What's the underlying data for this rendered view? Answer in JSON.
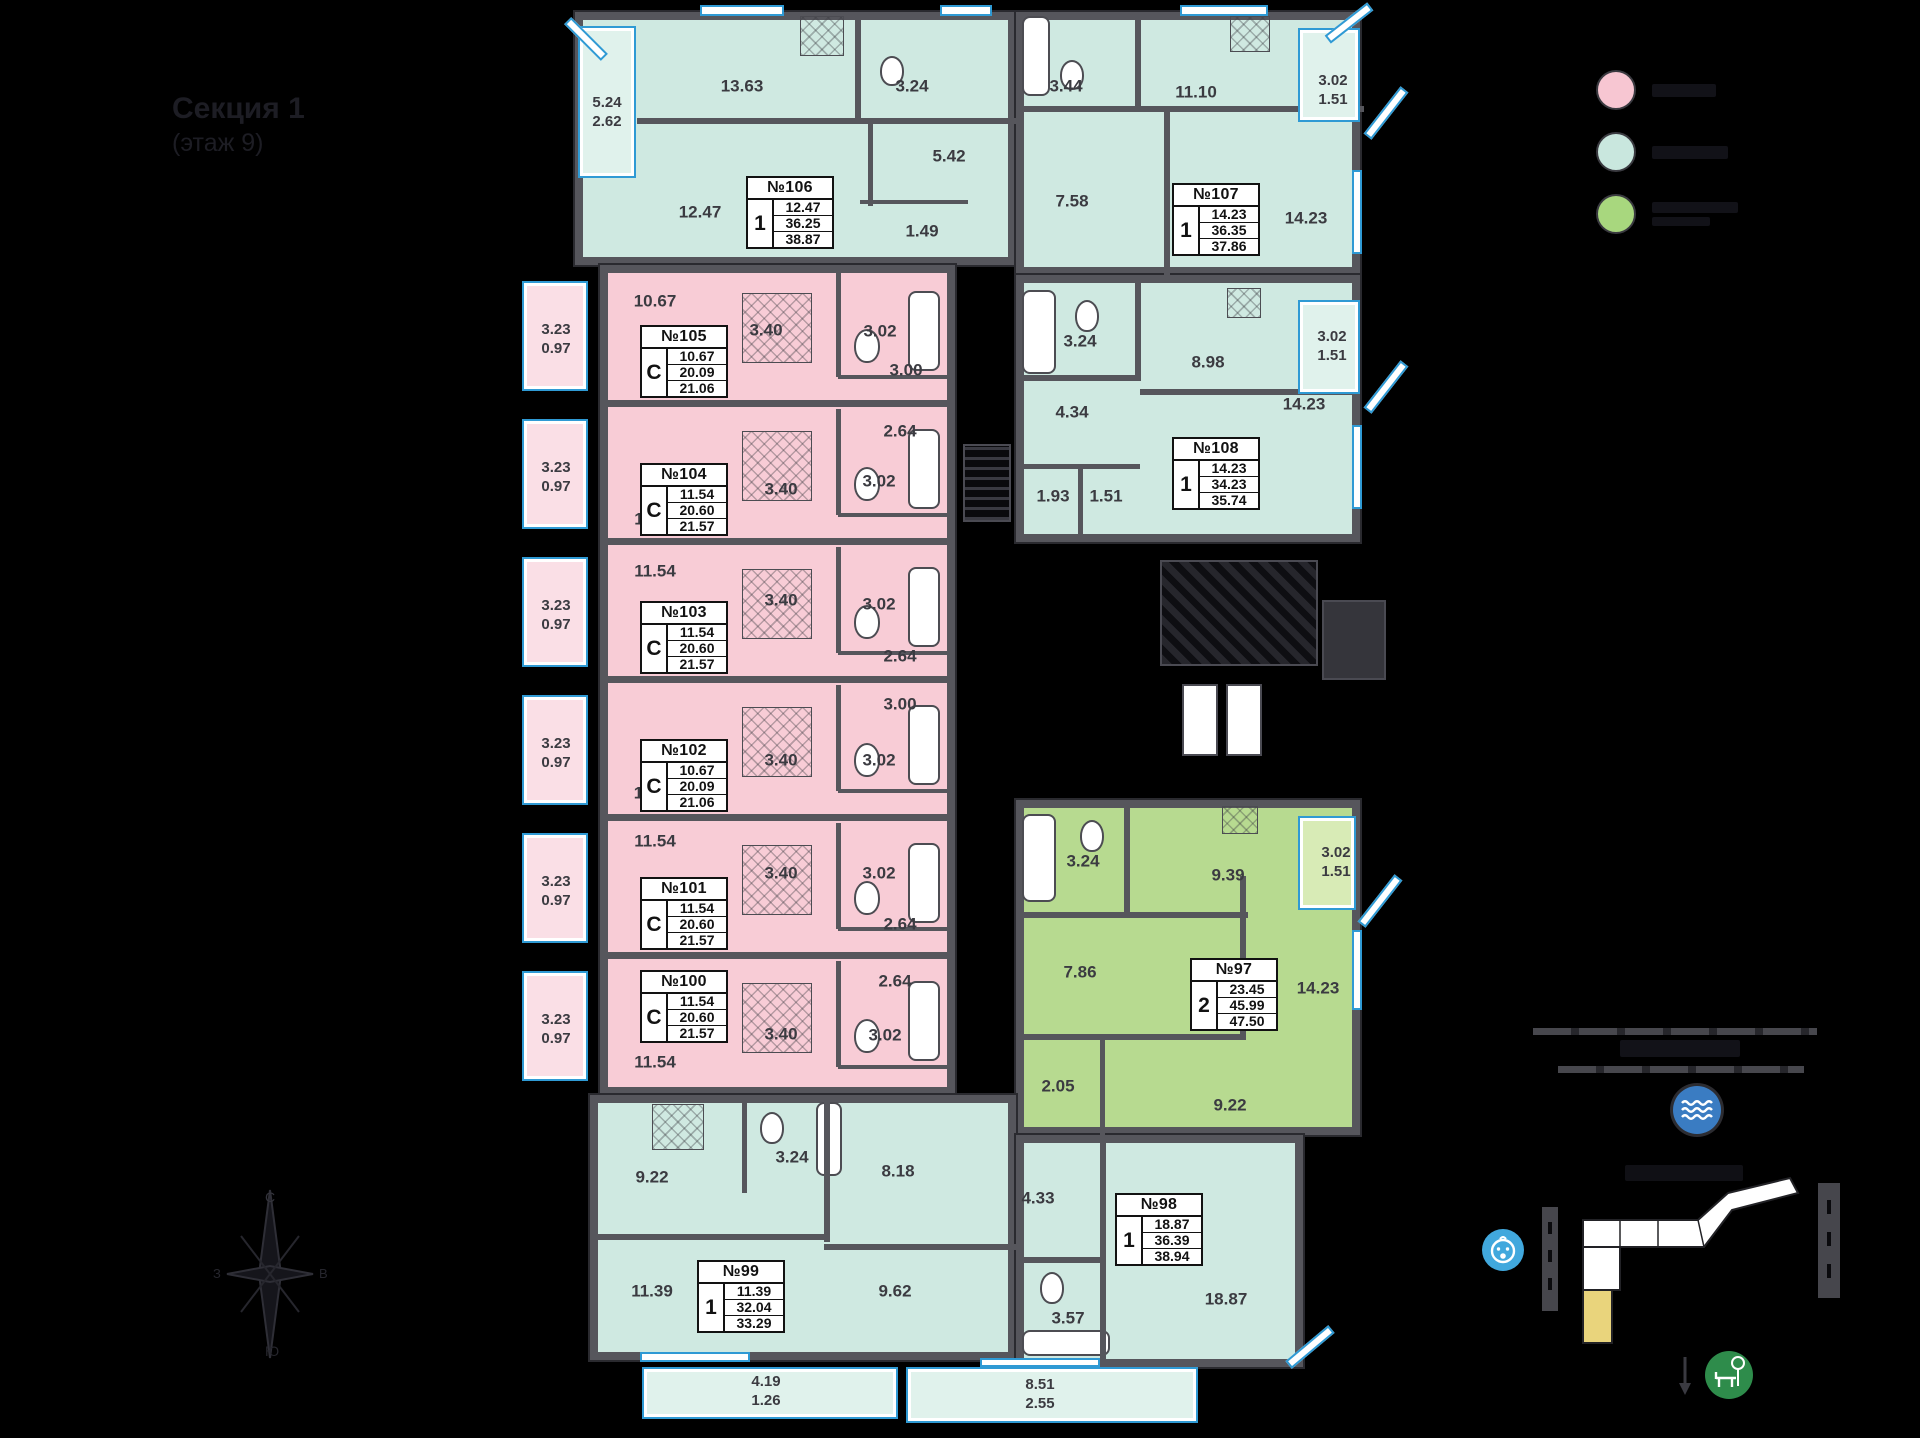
{
  "title": {
    "line1": "Секция 1",
    "line2": "(этаж 9)"
  },
  "legend": [
    {
      "name": "studio-apartments",
      "color": "#f7c6d2"
    },
    {
      "name": "one-room-apartments",
      "color": "#c9e7de"
    },
    {
      "name": "two-room-apartments",
      "color": "#a8d77e"
    }
  ],
  "colors": {
    "teal_fill": "#cfe9e1",
    "pink_fill": "#f8ccd6",
    "green_fill": "#b7da90",
    "wall": "#56565c",
    "window_blue": "#2f9ad4",
    "minimap_highlight": "#e9d47c",
    "water_icon": "#3a7cc2",
    "kindergarten_icon": "#41a8dd",
    "park_icon": "#2e8c4b"
  },
  "apartments": [
    {
      "num": "№106",
      "badge": "1",
      "living": "12.47",
      "area": "36.25",
      "total": "38.87",
      "box": {
        "x": 746,
        "y": 176
      }
    },
    {
      "num": "№107",
      "badge": "1",
      "living": "14.23",
      "area": "36.35",
      "total": "37.86",
      "box": {
        "x": 1172,
        "y": 183
      }
    },
    {
      "num": "№108",
      "badge": "1",
      "living": "14.23",
      "area": "34.23",
      "total": "35.74",
      "box": {
        "x": 1172,
        "y": 437
      }
    },
    {
      "num": "№105",
      "badge": "С",
      "living": "10.67",
      "area": "20.09",
      "total": "21.06",
      "box": {
        "x": 640,
        "y": 325
      }
    },
    {
      "num": "№104",
      "badge": "С",
      "living": "11.54",
      "area": "20.60",
      "total": "21.57",
      "box": {
        "x": 640,
        "y": 463
      }
    },
    {
      "num": "№103",
      "badge": "С",
      "living": "11.54",
      "area": "20.60",
      "total": "21.57",
      "box": {
        "x": 640,
        "y": 601
      }
    },
    {
      "num": "№102",
      "badge": "С",
      "living": "10.67",
      "area": "20.09",
      "total": "21.06",
      "box": {
        "x": 640,
        "y": 739
      }
    },
    {
      "num": "№101",
      "badge": "С",
      "living": "11.54",
      "area": "20.60",
      "total": "21.57",
      "box": {
        "x": 640,
        "y": 877
      }
    },
    {
      "num": "№100",
      "badge": "С",
      "living": "11.54",
      "area": "20.60",
      "total": "21.57",
      "box": {
        "x": 640,
        "y": 970
      }
    },
    {
      "num": "№97",
      "badge": "2",
      "living": "23.45",
      "area": "45.99",
      "total": "47.50",
      "box": {
        "x": 1190,
        "y": 958
      }
    },
    {
      "num": "№98",
      "badge": "1",
      "living": "18.87",
      "area": "36.39",
      "total": "38.94",
      "box": {
        "x": 1115,
        "y": 1193
      }
    },
    {
      "num": "№99",
      "badge": "1",
      "living": "11.39",
      "area": "32.04",
      "total": "33.29",
      "box": {
        "x": 697,
        "y": 1260
      }
    }
  ],
  "labels": [
    {
      "t": "13.63",
      "x": 742,
      "y": 86
    },
    {
      "t": "3.24",
      "x": 912,
      "y": 86
    },
    {
      "t": "5.42",
      "x": 949,
      "y": 156
    },
    {
      "t": "12.47",
      "x": 700,
      "y": 212
    },
    {
      "t": "1.49",
      "x": 922,
      "y": 231
    },
    {
      "t": "5.24",
      "t2": "2.62",
      "x": 607,
      "y": 112
    },
    {
      "t": "3.44",
      "x": 1066,
      "y": 86
    },
    {
      "t": "11.10",
      "x": 1196,
      "y": 92
    },
    {
      "t": "7.58",
      "x": 1072,
      "y": 201
    },
    {
      "t": "14.23",
      "x": 1306,
      "y": 218
    },
    {
      "t": "3.02",
      "t2": "1.51",
      "x": 1333,
      "y": 90
    },
    {
      "t": "3.24",
      "x": 1080,
      "y": 341
    },
    {
      "t": "8.98",
      "x": 1208,
      "y": 362
    },
    {
      "t": "4.34",
      "x": 1072,
      "y": 412
    },
    {
      "t": "1.93",
      "x": 1053,
      "y": 496
    },
    {
      "t": "1.51",
      "x": 1106,
      "y": 496
    },
    {
      "t": "14.23",
      "x": 1304,
      "y": 404
    },
    {
      "t": "3.02",
      "t2": "1.51",
      "x": 1332,
      "y": 346
    },
    {
      "t": "10.67",
      "x": 655,
      "y": 301
    },
    {
      "t": "3.40",
      "x": 766,
      "y": 330
    },
    {
      "t": "3.02",
      "x": 880,
      "y": 331
    },
    {
      "t": "3.00",
      "x": 906,
      "y": 370
    },
    {
      "t": "3.23",
      "t2": "0.97",
      "x": 556,
      "y": 339
    },
    {
      "t": "11.54",
      "x": 655,
      "y": 519
    },
    {
      "t": "3.40",
      "x": 781,
      "y": 489
    },
    {
      "t": "3.02",
      "x": 879,
      "y": 481
    },
    {
      "t": "2.64",
      "x": 900,
      "y": 431
    },
    {
      "t": "3.23",
      "t2": "0.97",
      "x": 556,
      "y": 477
    },
    {
      "t": "11.54",
      "x": 655,
      "y": 571
    },
    {
      "t": "3.40",
      "x": 781,
      "y": 600
    },
    {
      "t": "3.02",
      "x": 879,
      "y": 604
    },
    {
      "t": "2.64",
      "x": 900,
      "y": 656
    },
    {
      "t": "3.23",
      "t2": "0.97",
      "x": 556,
      "y": 615
    },
    {
      "t": "10.67",
      "x": 655,
      "y": 793
    },
    {
      "t": "3.40",
      "x": 781,
      "y": 760
    },
    {
      "t": "3.02",
      "x": 879,
      "y": 760
    },
    {
      "t": "3.00",
      "x": 900,
      "y": 704
    },
    {
      "t": "3.23",
      "t2": "0.97",
      "x": 556,
      "y": 753
    },
    {
      "t": "11.54",
      "x": 655,
      "y": 841
    },
    {
      "t": "3.40",
      "x": 781,
      "y": 873
    },
    {
      "t": "3.02",
      "x": 879,
      "y": 873
    },
    {
      "t": "2.64",
      "x": 900,
      "y": 924
    },
    {
      "t": "3.23",
      "t2": "0.97",
      "x": 556,
      "y": 891
    },
    {
      "t": "11.54",
      "x": 655,
      "y": 1062
    },
    {
      "t": "3.40",
      "x": 781,
      "y": 1034
    },
    {
      "t": "3.02",
      "x": 885,
      "y": 1035
    },
    {
      "t": "2.64",
      "x": 895,
      "y": 981
    },
    {
      "t": "3.23",
      "t2": "0.97",
      "x": 556,
      "y": 1029
    },
    {
      "t": "3.24",
      "x": 1083,
      "y": 861
    },
    {
      "t": "9.39",
      "x": 1228,
      "y": 875
    },
    {
      "t": "7.86",
      "x": 1080,
      "y": 972
    },
    {
      "t": "14.23",
      "x": 1318,
      "y": 988
    },
    {
      "t": "2.05",
      "x": 1058,
      "y": 1086
    },
    {
      "t": "9.22",
      "x": 1230,
      "y": 1105
    },
    {
      "t": "3.02",
      "t2": "1.51",
      "x": 1336,
      "y": 862
    },
    {
      "t": "9.22",
      "x": 652,
      "y": 1177
    },
    {
      "t": "3.24",
      "x": 792,
      "y": 1157
    },
    {
      "t": "8.18",
      "x": 898,
      "y": 1171
    },
    {
      "t": "11.39",
      "x": 652,
      "y": 1291
    },
    {
      "t": "4.19",
      "t2": "1.26",
      "x": 766,
      "y": 1391
    },
    {
      "t": "4.33",
      "x": 1038,
      "y": 1198
    },
    {
      "t": "3.57",
      "x": 1068,
      "y": 1318
    },
    {
      "t": "18.87",
      "x": 1226,
      "y": 1299
    },
    {
      "t": "9.62",
      "x": 895,
      "y": 1291
    },
    {
      "t": "8.51",
      "t2": "2.55",
      "x": 1040,
      "y": 1394
    }
  ],
  "compass": {
    "north": "С",
    "south": "Ю",
    "west": "З",
    "east": "В"
  }
}
